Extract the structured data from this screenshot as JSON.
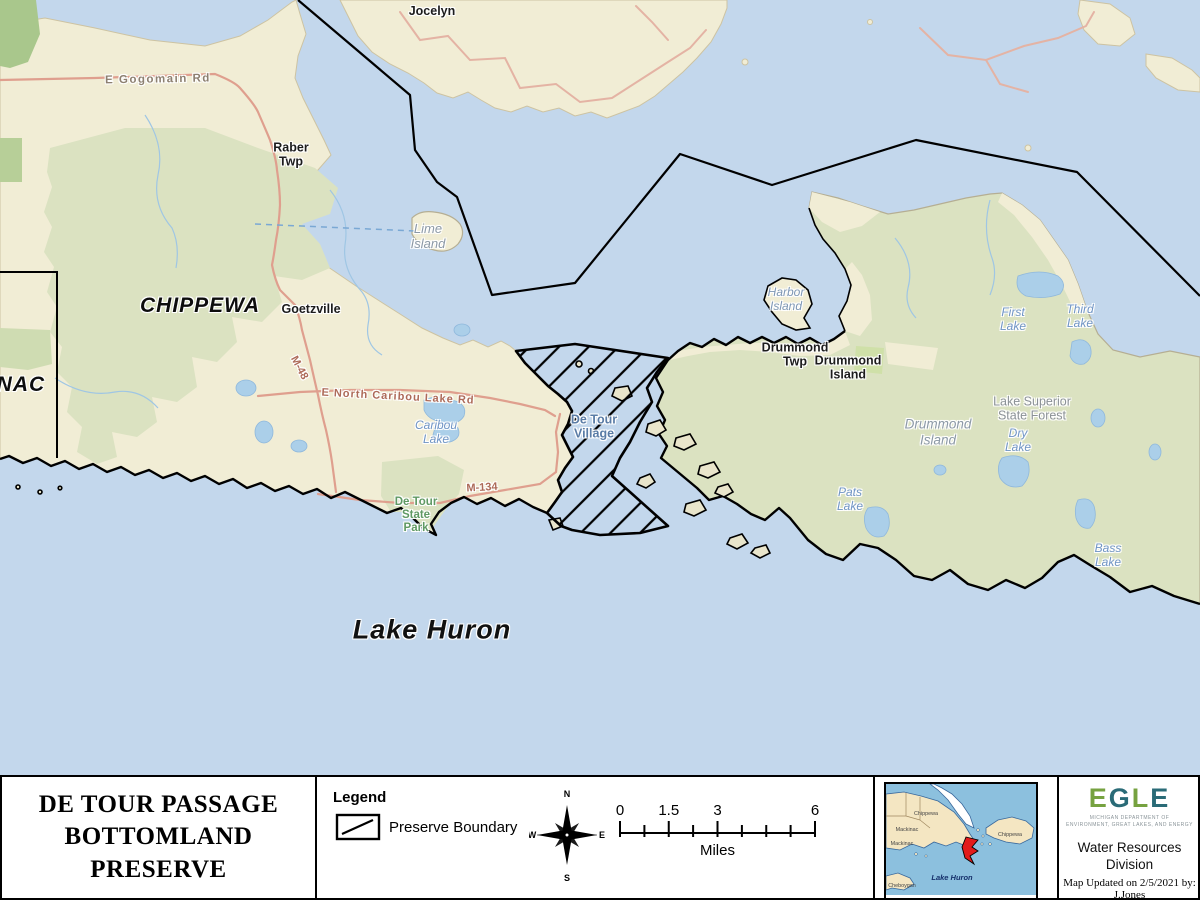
{
  "map": {
    "labels": {
      "jocelyn": "Jocelyn",
      "e_gogomain_rd": "E Gogomain Rd",
      "raber_twp": "Raber\nTwp",
      "chippewa": "CHIPPEWA",
      "mackinac": "MACKINAC",
      "goetzville": "Goetzville",
      "m48": "M-48",
      "e_north_caribou_lake_rd": "E North Caribou Lake Rd",
      "caribou_lake": "Caribou\nLake",
      "lime_island": "Lime\nIsland",
      "harbor_island": "Harbor\nIsland",
      "drummond_twp": "Drummond\nTwp",
      "drummond_island_town": "Drummond\nIsland",
      "drummond_island": "Drummond\nIsland",
      "de_tour_village": "De Tour\nVillage",
      "de_tour_state_park": "De Tour\nState\nPark",
      "m134": "M-134",
      "lake_huron": "Lake Huron",
      "first_lake": "First\nLake",
      "third_lake": "Third\nLake",
      "lake_superior_state_forest": "Lake Superior\nState Forest",
      "dry_lake": "Dry\nLake",
      "pats_lake": "Pats\nLake",
      "bass_lake": "Bass\nLake"
    }
  },
  "footer": {
    "title": "DE TOUR PASSAGE\nBOTTOMLAND\nPRESERVE",
    "legend": {
      "heading": "Legend",
      "preserve_boundary": "Preserve Boundary"
    },
    "compass": {
      "n": "N",
      "e": "E",
      "s": "S",
      "w": "W"
    },
    "scale": {
      "t0": "0",
      "t1": "1.5",
      "t2": "3",
      "t3": "6",
      "unit": "Miles"
    },
    "inset": {
      "chippewa_n": "Chippewa",
      "mackinac": "Mackinac",
      "mackinac_s": "Mackinac",
      "chippewa_e": "Chippewa",
      "cheboygan": "Cheboygan",
      "lake_huron": "Lake Huron"
    },
    "agency": {
      "letters": [
        "E",
        "G",
        "L",
        "E"
      ],
      "tagline1": "MICHIGAN DEPARTMENT OF",
      "tagline2": "ENVIRONMENT, GREAT LAKES, AND ENERGY",
      "division": "Water Resources\nDivision",
      "updated": "Map Updated on 2/5/2021 by:",
      "author": "J.Jones"
    }
  },
  "colors": {
    "water": "#c3d7ec",
    "land": "#f1edd5",
    "forest": "#dbe2c1",
    "dark_forest": "#a9c78c",
    "road": "#df9f8e",
    "boundary": "#000000",
    "egle_green": "#76a240",
    "egle_teal": "#2a6b77",
    "inset_marker_red": "#e21b1b",
    "inset_water": "#8cc0de",
    "inset_land": "#f4e6c2"
  }
}
